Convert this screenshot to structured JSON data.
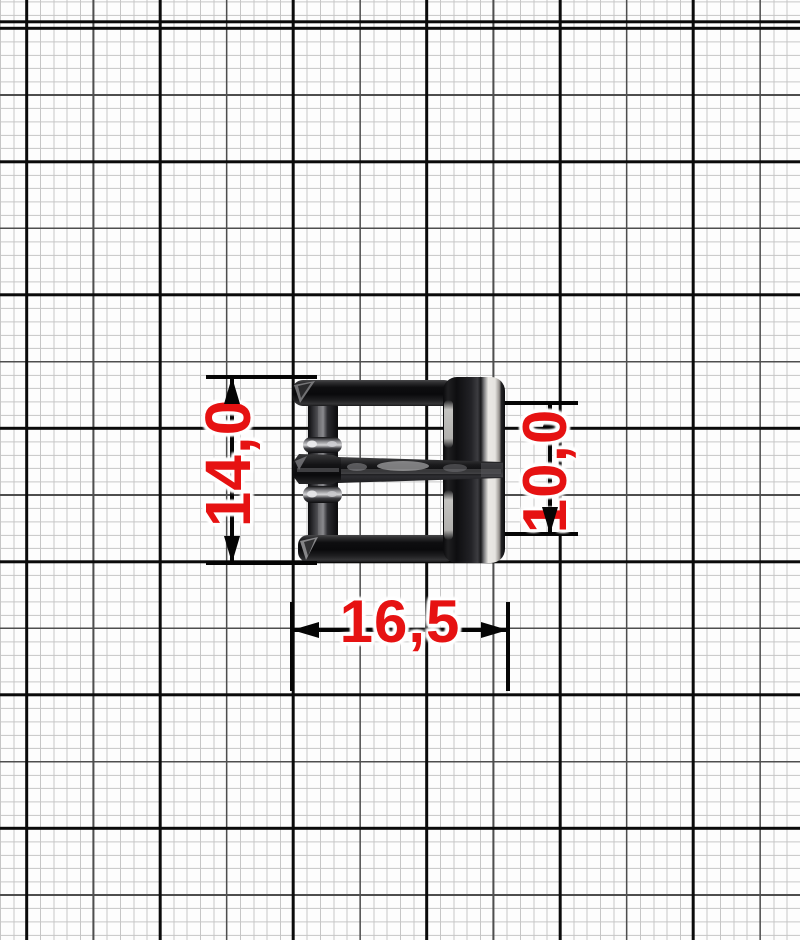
{
  "grid": {
    "background": "#fdfdfd",
    "minor_line_color": "#c6c6c6",
    "mid_line_color": "#4e4e4e",
    "major_line_color": "#0a0a0a"
  },
  "buckle": {
    "object": "roller-pin-belt-buckle",
    "body_color": "#121214",
    "edge_highlight_color": "#e9e7e3"
  },
  "dimensions": {
    "color": "#e61212",
    "height": {
      "label": "14,0",
      "orientation": "vertical"
    },
    "strap_width": {
      "label": "10,0",
      "orientation": "vertical"
    },
    "width": {
      "label": "16,5",
      "orientation": "horizontal"
    }
  }
}
